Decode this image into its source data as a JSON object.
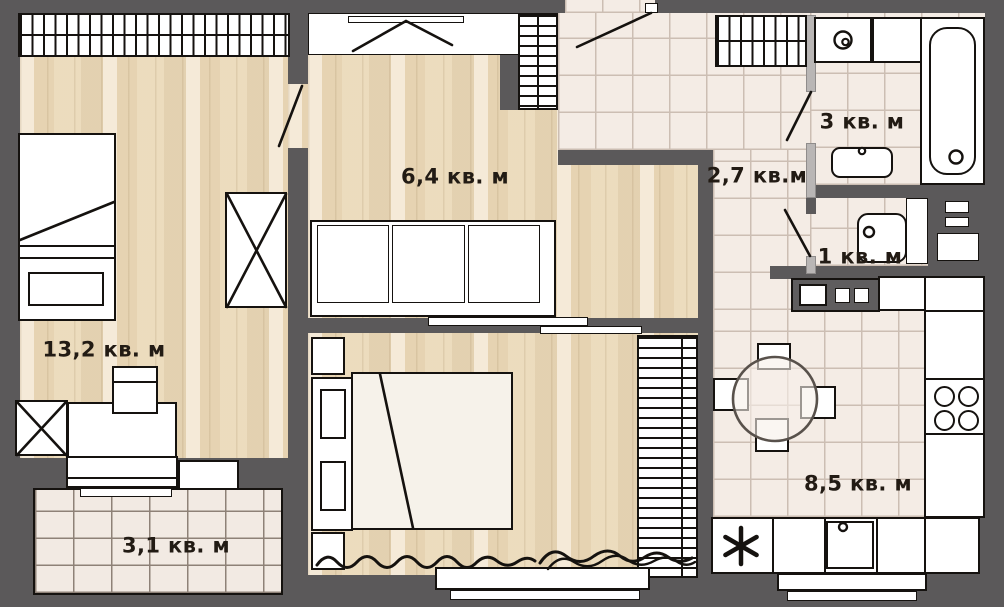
{
  "rooms": {
    "living": {
      "label": "13,2 кв. м"
    },
    "lounge": {
      "label": "6,4 кв. м"
    },
    "balcony": {
      "label": "3,1 кв. м"
    },
    "bathroom": {
      "label": "3 кв. м"
    },
    "hallway": {
      "label": "2,7 кв.м"
    },
    "wc": {
      "label": "1 кв. м"
    },
    "kitchen": {
      "label": "8,5 кв. м"
    }
  },
  "icons": {
    "washing_machine": "spiral-drum-icon",
    "fridge": "snowflake-asterisk-icon",
    "stove": "four-burner-icon"
  },
  "colors": {
    "wall": "#5b595a",
    "wood_floor": "#e9dabd",
    "tile_floor": "#f4ece5",
    "balcony_tile": "#f2eae3",
    "line": "#15120f",
    "furniture": "#ffffff"
  }
}
